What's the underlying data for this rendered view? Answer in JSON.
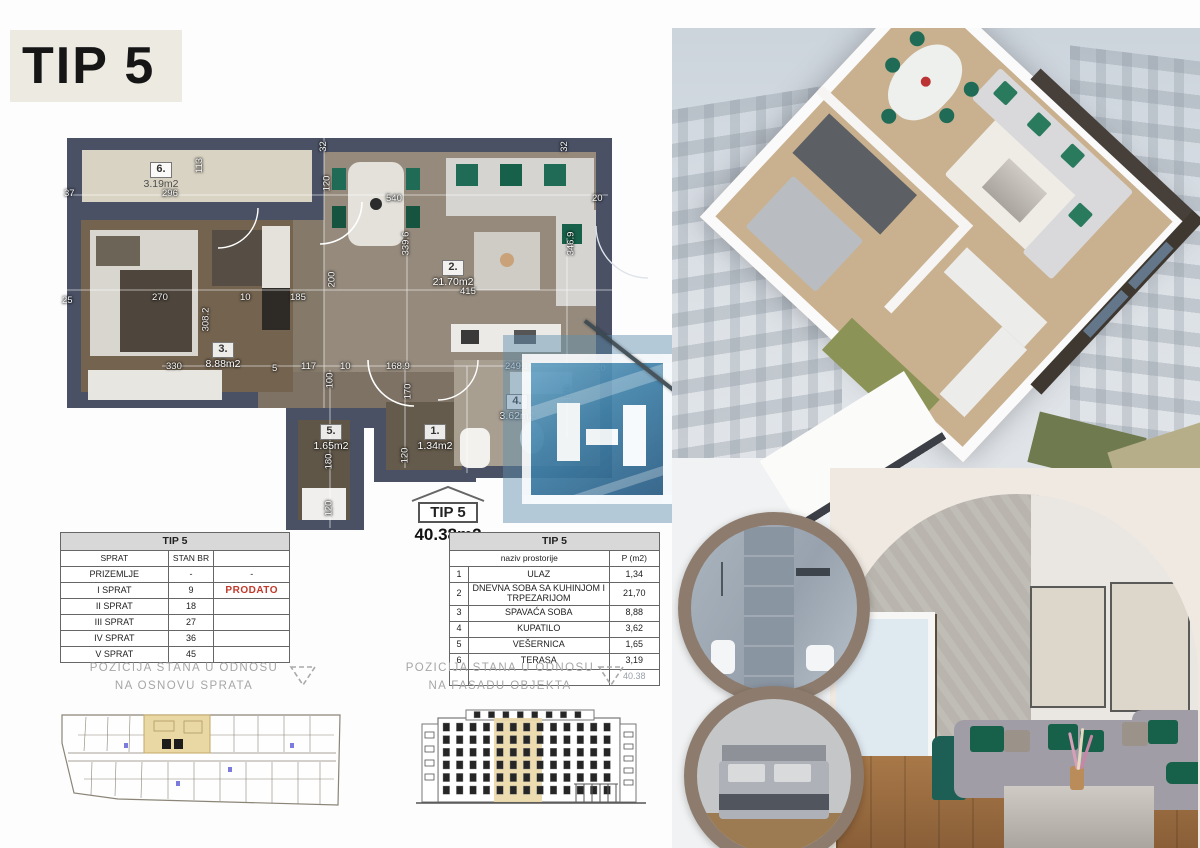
{
  "header": {
    "title": "TIP 5"
  },
  "plan": {
    "stamp_type": "TIP 5",
    "stamp_area": "40.38m2",
    "rooms": [
      {
        "num": "6.",
        "area": "3.19m2",
        "x": 64,
        "y": 24,
        "dark": true
      },
      {
        "num": "2.",
        "area": "21.70m2",
        "x": 356,
        "y": 122,
        "dark": false
      },
      {
        "num": "3.",
        "area": "8.88m2",
        "x": 126,
        "y": 204,
        "dark": false
      },
      {
        "num": "4.",
        "area": "3.62m2",
        "x": 420,
        "y": 256,
        "dark": false
      },
      {
        "num": "5.",
        "area": "1.65m2",
        "x": 234,
        "y": 286,
        "dark": false
      },
      {
        "num": "1.",
        "area": "1.34m2",
        "x": 338,
        "y": 286,
        "dark": false
      }
    ],
    "dimensions": [
      {
        "t": "37",
        "x": 2,
        "y": 50
      },
      {
        "t": "296",
        "x": 100,
        "y": 50
      },
      {
        "t": "113",
        "x": 130,
        "y": 22,
        "v": 1
      },
      {
        "t": "32",
        "x": 256,
        "y": 3,
        "v": 1
      },
      {
        "t": "120",
        "x": 257,
        "y": 40,
        "v": 1
      },
      {
        "t": "32",
        "x": 497,
        "y": 3,
        "v": 1
      },
      {
        "t": "540",
        "x": 324,
        "y": 55
      },
      {
        "t": "20",
        "x": 530,
        "y": 55
      },
      {
        "t": "25",
        "x": 0,
        "y": 157
      },
      {
        "t": "270",
        "x": 90,
        "y": 154
      },
      {
        "t": "10",
        "x": 178,
        "y": 154
      },
      {
        "t": "185",
        "x": 228,
        "y": 154
      },
      {
        "t": "200",
        "x": 262,
        "y": 136,
        "v": 1
      },
      {
        "t": "308.2",
        "x": 132,
        "y": 176,
        "v": 1
      },
      {
        "t": "339.6",
        "x": 332,
        "y": 100,
        "v": 1
      },
      {
        "t": "346.9",
        "x": 497,
        "y": 100,
        "v": 1
      },
      {
        "t": "415",
        "x": 398,
        "y": 148
      },
      {
        "t": "330",
        "x": 104,
        "y": 223
      },
      {
        "t": "5",
        "x": 210,
        "y": 225
      },
      {
        "t": "117",
        "x": 239,
        "y": 223
      },
      {
        "t": "10",
        "x": 278,
        "y": 223
      },
      {
        "t": "100",
        "x": 260,
        "y": 237,
        "v": 1
      },
      {
        "t": "168.9",
        "x": 324,
        "y": 223
      },
      {
        "t": "170",
        "x": 338,
        "y": 248,
        "v": 1
      },
      {
        "t": "249.1",
        "x": 443,
        "y": 223
      },
      {
        "t": "20",
        "x": 533,
        "y": 225
      },
      {
        "t": "160",
        "x": 498,
        "y": 250,
        "v": 1
      },
      {
        "t": "180",
        "x": 259,
        "y": 318,
        "v": 1
      },
      {
        "t": "120",
        "x": 259,
        "y": 365,
        "v": 1
      },
      {
        "t": "120",
        "x": 335,
        "y": 312,
        "v": 1
      }
    ]
  },
  "floors_table": {
    "title": "TIP 5",
    "col_floor": "SPRAT",
    "col_unit": "STAN BR",
    "rows": [
      {
        "sprat": "PRIZEMLJE",
        "stan": "-",
        "note": "-",
        "red": false
      },
      {
        "sprat": "I SPRAT",
        "stan": "9",
        "note": "PRODATO",
        "red": true
      },
      {
        "sprat": "II SPRAT",
        "stan": "18",
        "note": "",
        "red": false
      },
      {
        "sprat": "III SPRAT",
        "stan": "27",
        "note": "",
        "red": false
      },
      {
        "sprat": "IV SPRAT",
        "stan": "36",
        "note": "",
        "red": false
      },
      {
        "sprat": "V SPRAT",
        "stan": "45",
        "note": "",
        "red": false
      }
    ]
  },
  "rooms_table": {
    "title": "TIP 5",
    "header_name": "naziv prostorije",
    "header_area": "P (m2)",
    "rows": [
      {
        "n": "1",
        "name": "ULAZ",
        "area": "1,34"
      },
      {
        "n": "2",
        "name": "DNEVNA SOBA SA KUHINJOM I TRPEZARIJOM",
        "area": "21,70"
      },
      {
        "n": "3",
        "name": "SPAVAĆA SOBA",
        "area": "8,88"
      },
      {
        "n": "4",
        "name": "KUPATILO",
        "area": "3,62"
      },
      {
        "n": "5",
        "name": "VEŠERNICA",
        "area": "1,65"
      },
      {
        "n": "6",
        "name": "TERASA",
        "area": "3,19"
      }
    ],
    "total": "40.38"
  },
  "captions": {
    "floor_line1": "POZICIJA STANA U ODNOSU",
    "floor_line2": "NA OSNOVU SPRATA",
    "facade_line1": "POZICIJA STANA U ODNOSU",
    "facade_line2": "NA FASADU OBJEKTA"
  },
  "colors": {
    "wall": "#4a5164",
    "terrace_floor": "#d9d3c3",
    "living_floor": "#958a7c",
    "bedroom_floor": "#73634f",
    "bath_floor": "#a99f91",
    "accent_green": "#1f6b55",
    "prodato_red": "#c0392b",
    "table_header_bg": "#d8d8d8",
    "highlight_tan": "#ead9a9",
    "logo_blue": "#4181a8",
    "circle_border": "#8d7c6e",
    "caption_gray": "#a6a6a6"
  }
}
